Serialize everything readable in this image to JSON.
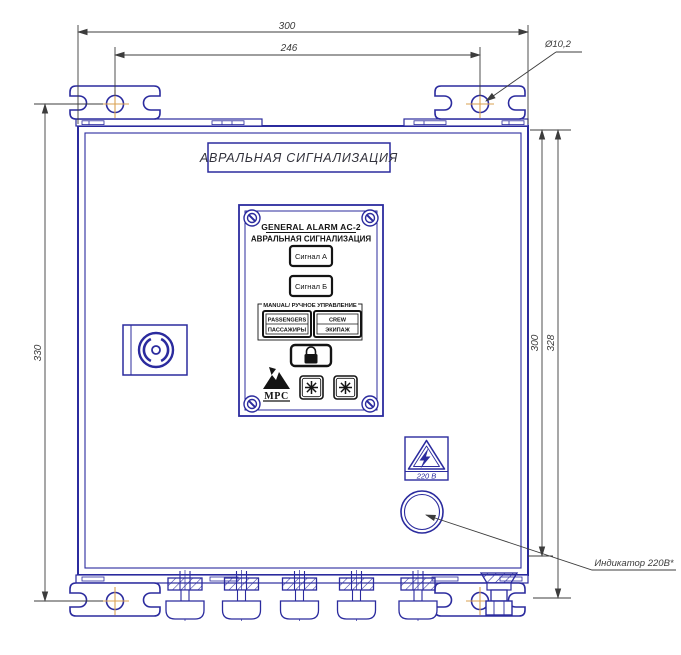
{
  "colors": {
    "line_navy": "#2b2b9e",
    "panel_black": "#141414",
    "dimension_gray": "#3c3c3c",
    "center_mark_orange": "#d9a050"
  },
  "dims": {
    "top_width": "300",
    "hole_span": "246",
    "left_height": "330",
    "right_inner": "300",
    "right_outer": "328"
  },
  "notes": {
    "hole_dia": "Ø10,2",
    "indicator": "Индикатор 220В*"
  },
  "title_plate": {
    "text": "АВРАЛЬНАЯ СИГНАЛИЗАЦИЯ"
  },
  "panel": {
    "title_en": "GENERAL ALARM AC-2",
    "title_ru": "АВРАЛЬНАЯ СИГНАЛИЗАЦИЯ",
    "signal_a": "Сигнал А",
    "signal_b": "Сигнал Б",
    "manual_label": "MANUAL/ РУЧНОЕ УПРАВЛЕНИЕ",
    "passengers_en": "PASSENGERS",
    "passengers_ru": "ПАССАЖИРЫ",
    "crew_en": "CREW",
    "crew_ru": "ЭКИПАЖ",
    "logo": "МРС"
  },
  "labels": {
    "voltage": "220 В"
  }
}
